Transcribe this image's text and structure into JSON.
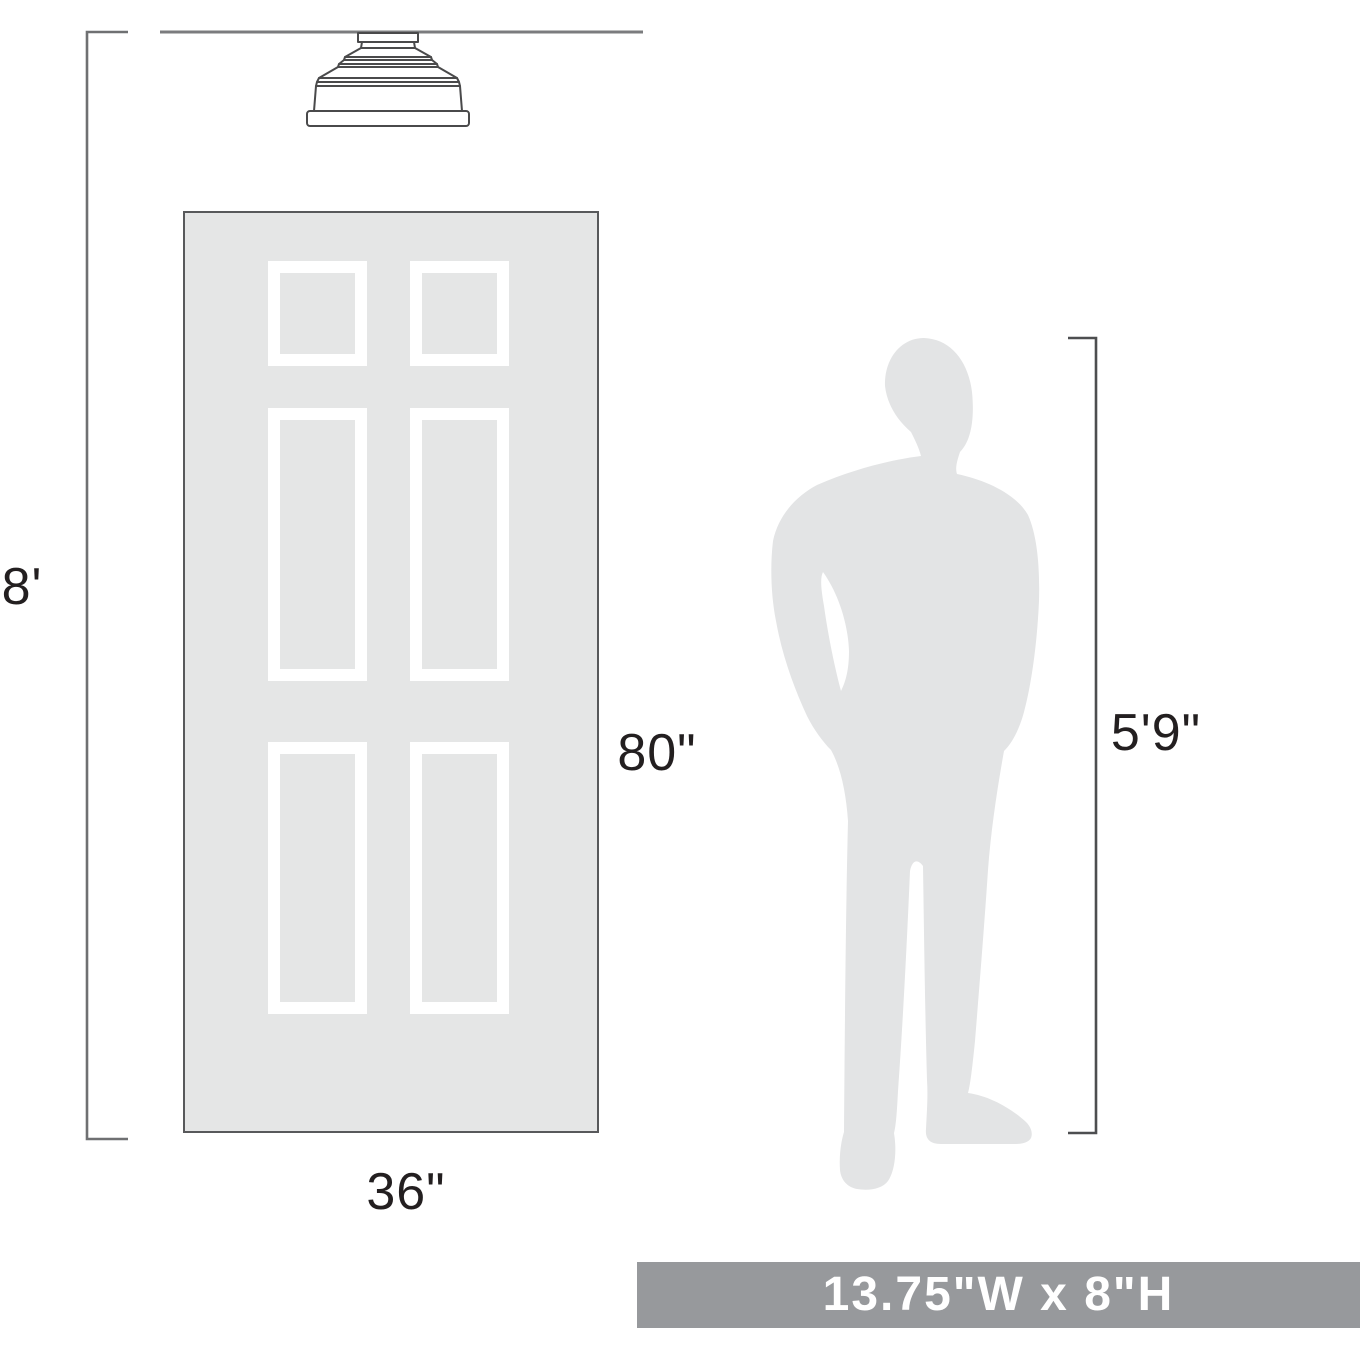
{
  "labels": {
    "ceiling_height": "8'",
    "door_height": "80\"",
    "door_width": "36\"",
    "person_height": "5'9\""
  },
  "banner": {
    "text": "13.75\"W x 8\"H"
  },
  "icons": {
    "fixture": "flush-mount-ceiling-light",
    "door": "six-panel-door",
    "person": "man-silhouette"
  },
  "colors": {
    "background": "#ffffff",
    "door_fill": "#e5e6e6",
    "door_border": "#58595b",
    "panel_frame": "#ffffff",
    "person_fill": "#e3e4e5",
    "ceiling_line": "#7b7c7e",
    "bracket_left": "#6f7072",
    "bracket_right": "#4d4e50",
    "fixture_outline": "#4a4a4b",
    "label_text": "#231f20",
    "banner_bg": "#97999c",
    "banner_text": "#ffffff"
  }
}
